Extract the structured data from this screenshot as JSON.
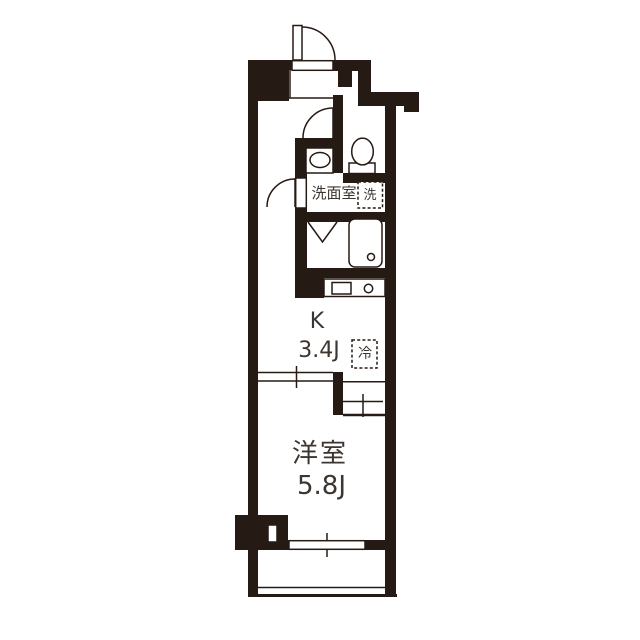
{
  "floorplan": {
    "title": "1K apartment floor plan",
    "colors": {
      "wall": "#261a14",
      "line": "#261a14",
      "bg": "#ffffff",
      "text": "#3c3530"
    },
    "rooms": {
      "washroom": {
        "label": "洗面室"
      },
      "washer_storage": {
        "label": "洗"
      },
      "kitchen": {
        "label": "K",
        "size": "3.4J"
      },
      "refrigerator": {
        "label": "冷"
      },
      "western_room": {
        "label": "洋室",
        "size": "5.8J"
      }
    },
    "fixtures": [
      "entrance-door",
      "toilet",
      "vanity-sink",
      "bathtub",
      "kitchen-counter",
      "kitchen-sink",
      "burner",
      "washer-space",
      "refrigerator-space",
      "sliding-partition",
      "window",
      "balcony"
    ]
  }
}
